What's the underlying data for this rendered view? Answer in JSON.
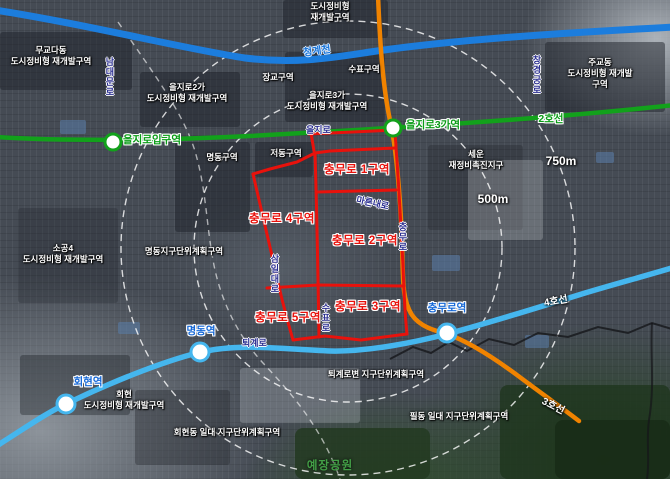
{
  "map": {
    "stream": {
      "label": "청계천",
      "color": "#1c7ddd"
    },
    "subway_lines": [
      {
        "id": "line-2",
        "label": "2호선",
        "color": "#12a11b"
      },
      {
        "id": "line-3",
        "label": "3호선",
        "color": "#f08300"
      },
      {
        "id": "line-4",
        "label": "4호선",
        "color": "#45b6ee"
      }
    ],
    "stations": [
      {
        "id": "euljiro-ipgu",
        "label": "을지로입구역"
      },
      {
        "id": "euljiro-3ga",
        "label": "을지로3가역"
      },
      {
        "id": "myeongdong",
        "label": "명동역"
      },
      {
        "id": "hoehyeon",
        "label": "회현역"
      },
      {
        "id": "chungmuro",
        "label": "충무로역"
      }
    ],
    "chungmuro_districts": [
      {
        "label": "충무로 1구역"
      },
      {
        "label": "충무로 4구역"
      },
      {
        "label": "충무로 2구역"
      },
      {
        "label": "충무로 5구역"
      },
      {
        "label": "충무로 3구역"
      }
    ],
    "zones": [
      {
        "id": "mugyodadong",
        "text": "무교다동\n도시정비형 재개발구역"
      },
      {
        "id": "top-center",
        "text": "도시정비형\n재개발구역"
      },
      {
        "id": "euljiro-2ga",
        "text": "을지로2가\n도시정비형 재개발구역"
      },
      {
        "id": "janggyo",
        "text": "장교구역"
      },
      {
        "id": "supyo",
        "text": "수표구역"
      },
      {
        "id": "euljiro-3ga",
        "text": "을지로3가\n도시정비형 재개발구역"
      },
      {
        "id": "jugyodong",
        "text": "주교동\n도시정비형 재개발구역"
      },
      {
        "id": "myeongdong-block",
        "text": "명동구역"
      },
      {
        "id": "jeodong-block",
        "text": "저동구역"
      },
      {
        "id": "sewoon",
        "text": "세운\n재정비촉진지구"
      },
      {
        "id": "myeongdong-district",
        "text": "명동지구단위계획구역"
      },
      {
        "id": "sogong4",
        "text": "소공4\n도시정비형 재개발구역"
      },
      {
        "id": "hoehyeon-redev",
        "text": "회현\n도시정비형 재개발구역"
      },
      {
        "id": "toegyero-byeon",
        "text": "퇴계로변 지구단위계획구역"
      },
      {
        "id": "pildong",
        "text": "필동 일대 지구단위계획구역"
      },
      {
        "id": "hoehyeondong",
        "text": "회현동 일대 지구단위계획구역"
      }
    ],
    "roads": [
      {
        "label": "남대문로"
      },
      {
        "label": "을지로"
      },
      {
        "label": "창경궁로"
      },
      {
        "label": "마른내로"
      },
      {
        "label": "충무로"
      },
      {
        "label": "수표로"
      },
      {
        "label": "삼일대로"
      },
      {
        "label": "퇴계로"
      }
    ],
    "radius_labels": {
      "inner": "500m",
      "outer": "750m"
    },
    "park": {
      "label": "예장공원",
      "color": "#43a047"
    },
    "colors": {
      "district_boundary_red": "#e8120c",
      "road_label_navy": "#2b2f91",
      "station_label_blue": "#1467d6",
      "station_label_green": "#0a9c16",
      "zone_label_white": "#ffffff"
    }
  }
}
